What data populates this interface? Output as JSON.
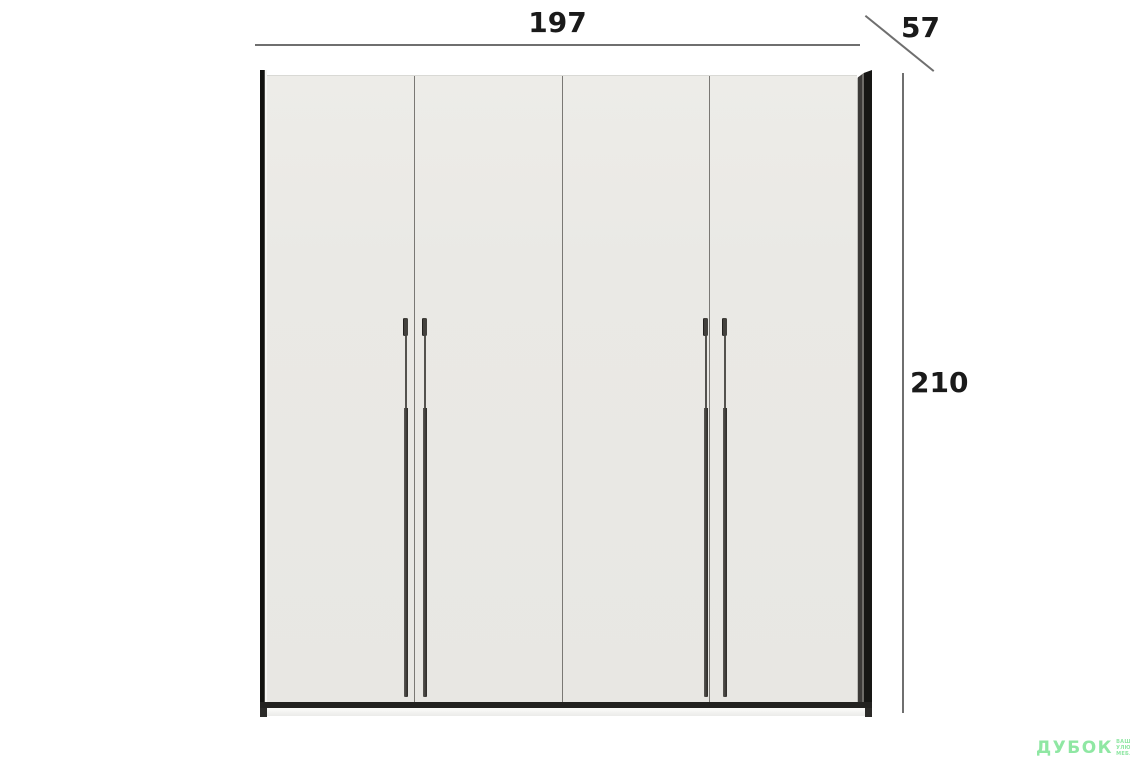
{
  "product": {
    "name": "four-door wardrobe",
    "door_count": 4,
    "handle_pairs": 2
  },
  "dimensions": {
    "width_cm": "197",
    "depth_cm": "57",
    "height_cm": "210"
  },
  "watermark": {
    "brand": "ДУБОК",
    "tagline": [
      "ВАШІ",
      "УЛЮБЛЕНІ",
      "МЕБЛІ"
    ]
  },
  "colors": {
    "background": "#ffffff",
    "door_face": "#eae9e5",
    "frame_dark": "#161614",
    "seam": "#7a7874",
    "dimension_line": "#6f6f6f",
    "dimension_text": "#1a1a1a",
    "watermark_green": "#8fe7a3"
  }
}
